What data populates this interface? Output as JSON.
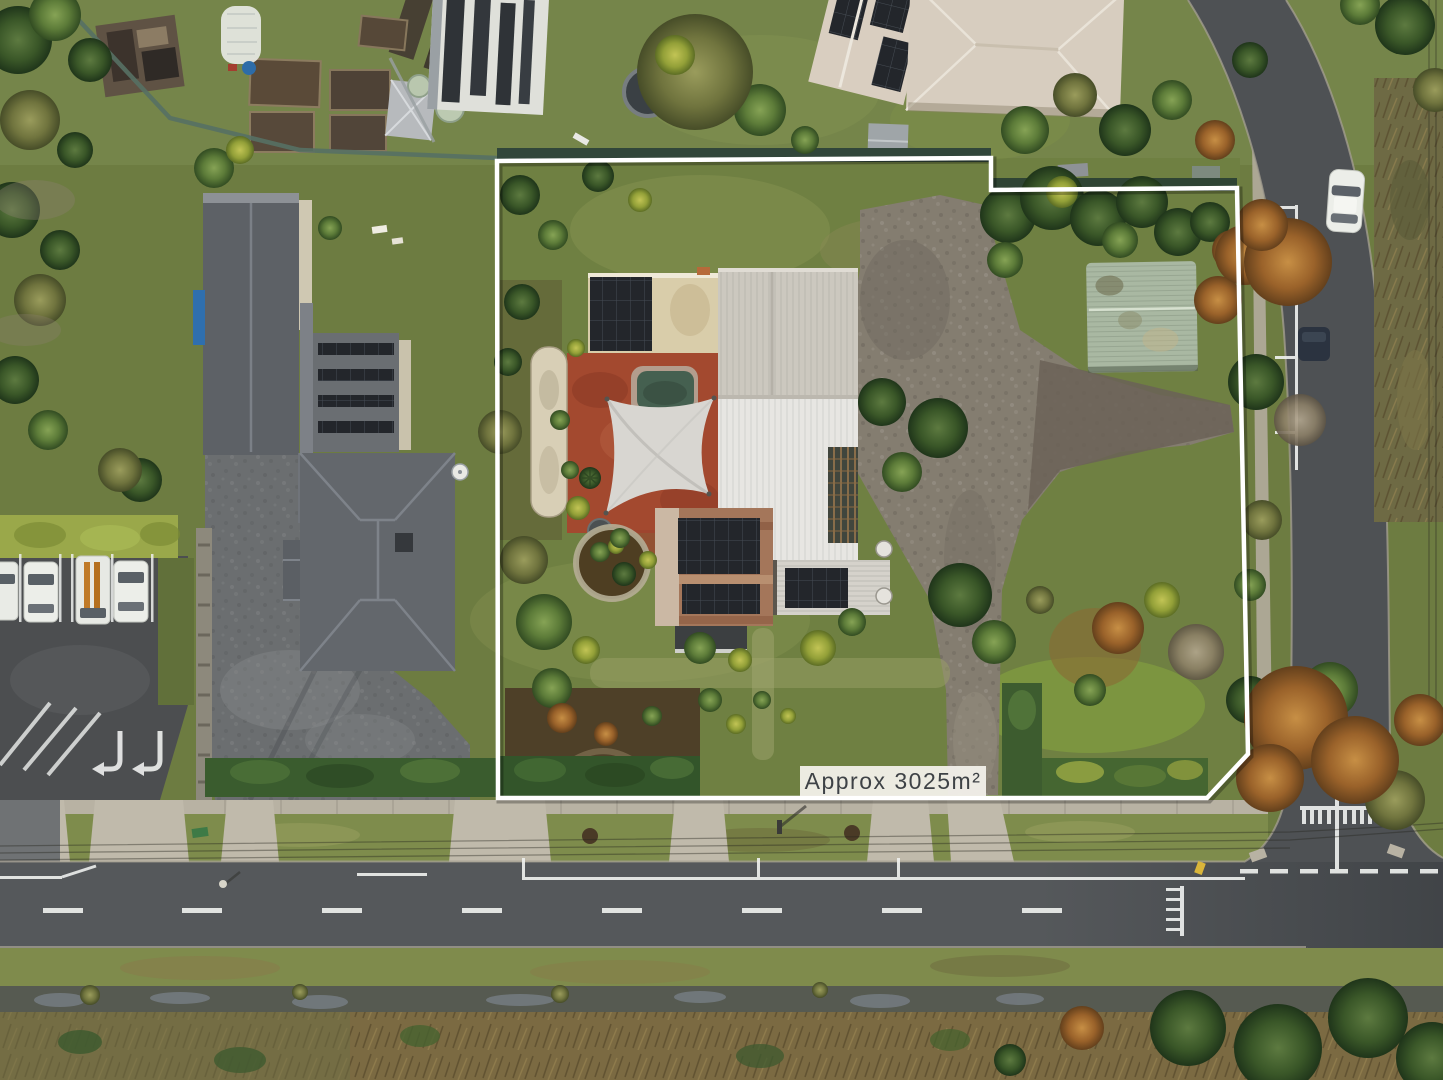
{
  "image": {
    "type": "aerial-drone-photograph",
    "subject": "residential property for sale with marked site boundary",
    "width_px": 1443,
    "height_px": 1080
  },
  "annotation": {
    "area_label": "Approx 3025m²"
  },
  "boundary": {
    "points": "497,161 991,158 991,190 1237,188 1248,754 1207,798 498,798",
    "stroke_color": "#ffffff",
    "stroke_width": "4.5",
    "label_box_fill": "#f2f0ea",
    "label_text_color": "#3e4246"
  },
  "palette": {
    "road_asphalt": "#55585b",
    "parking_asphalt": "#4c4e50",
    "footpath_concrete": "#b8b2a3",
    "driveway_concrete": "#c0baab",
    "lawn_green": "#6f8042",
    "verge_green": "#7e8c4c",
    "hedge_green": "#33552a",
    "wetland_reeds": "#7b6a42",
    "ditch_water": "#565a51",
    "main_roof_white": "#e7e6e2",
    "upper_roof_grey": "#ccc8bf",
    "church_roof_slate": "#63676c",
    "shed_roof_green": "#a9b8a2",
    "rusted_roof": "#a4765a",
    "solar_panel": "#23262b",
    "courtyard_paving": "#a3492f",
    "pool_water": "#456050",
    "gravel_drive": "#847d70",
    "marking_white": "#eef0ee",
    "car_white": "#eceee9",
    "car_navy": "#2b3340"
  },
  "scene_features": [
    "white-roofed weatherboard house with rooftop solar arrays",
    "shade sail over red paved courtyard with plunge pool",
    "rusted-roof outbuilding with large solar panels",
    "green-roofed shed among mature trees",
    "gravel driveway to street entrance",
    "neighbouring church hall with slate roof and car park",
    "street with parking bays, give-way markings and T-intersection",
    "roadside swale and reed bed along lower edge",
    "white surveyed boundary overlay with area label"
  ]
}
